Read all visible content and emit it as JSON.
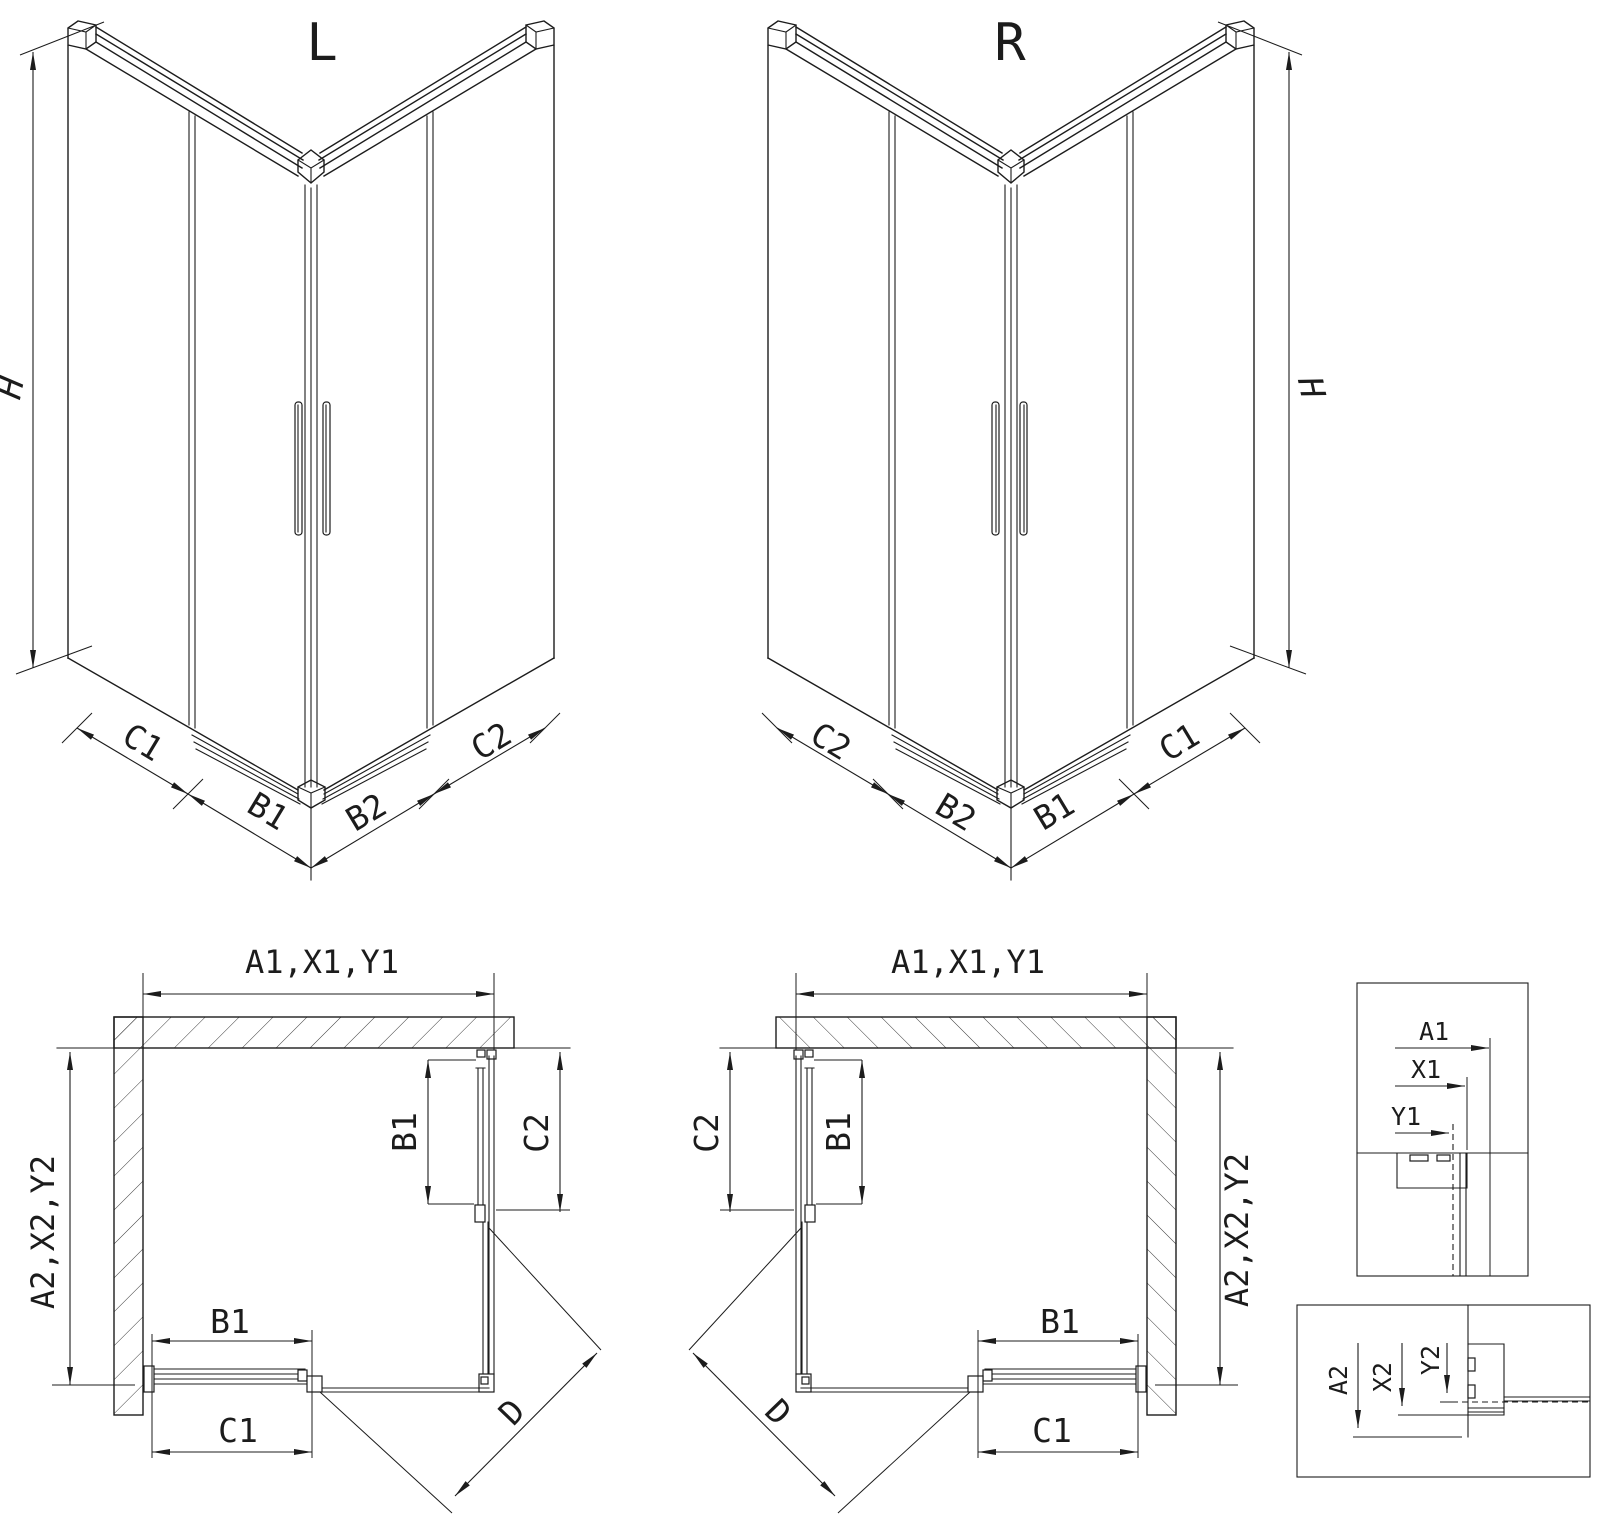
{
  "meta": {
    "background_color": "#ffffff",
    "line_color": "#1c1c1c",
    "drawing_type": "shower-enclosure-dimension-diagram"
  },
  "labels": {
    "title_left": "L",
    "title_right": "R",
    "elev_left": {
      "h": "H",
      "c1": "C1",
      "b1": "B1",
      "b2": "B2",
      "c2": "C2"
    },
    "elev_right": {
      "h": "H",
      "c2": "C2",
      "b2": "B2",
      "b1": "B1",
      "c1": "C1"
    },
    "plan_left": {
      "a1": "A1,X1,Y1",
      "a2": "A2,X2,Y2",
      "b1_side": "B1",
      "c2_side": "C2",
      "b1_bottom": "B1",
      "c1_bottom": "C1",
      "d": "D"
    },
    "plan_right": {
      "a1": "A1,X1,Y1",
      "a2": "A2,X2,Y2",
      "b1_side": "B1",
      "c2_side": "C2",
      "b1_bottom": "B1",
      "c1_bottom": "C1",
      "d": "D"
    },
    "detail_top": {
      "a1": "A1",
      "x1": "X1",
      "y1": "Y1"
    },
    "detail_bottom": {
      "a2": "A2",
      "x2": "X2",
      "y2": "Y2"
    }
  }
}
